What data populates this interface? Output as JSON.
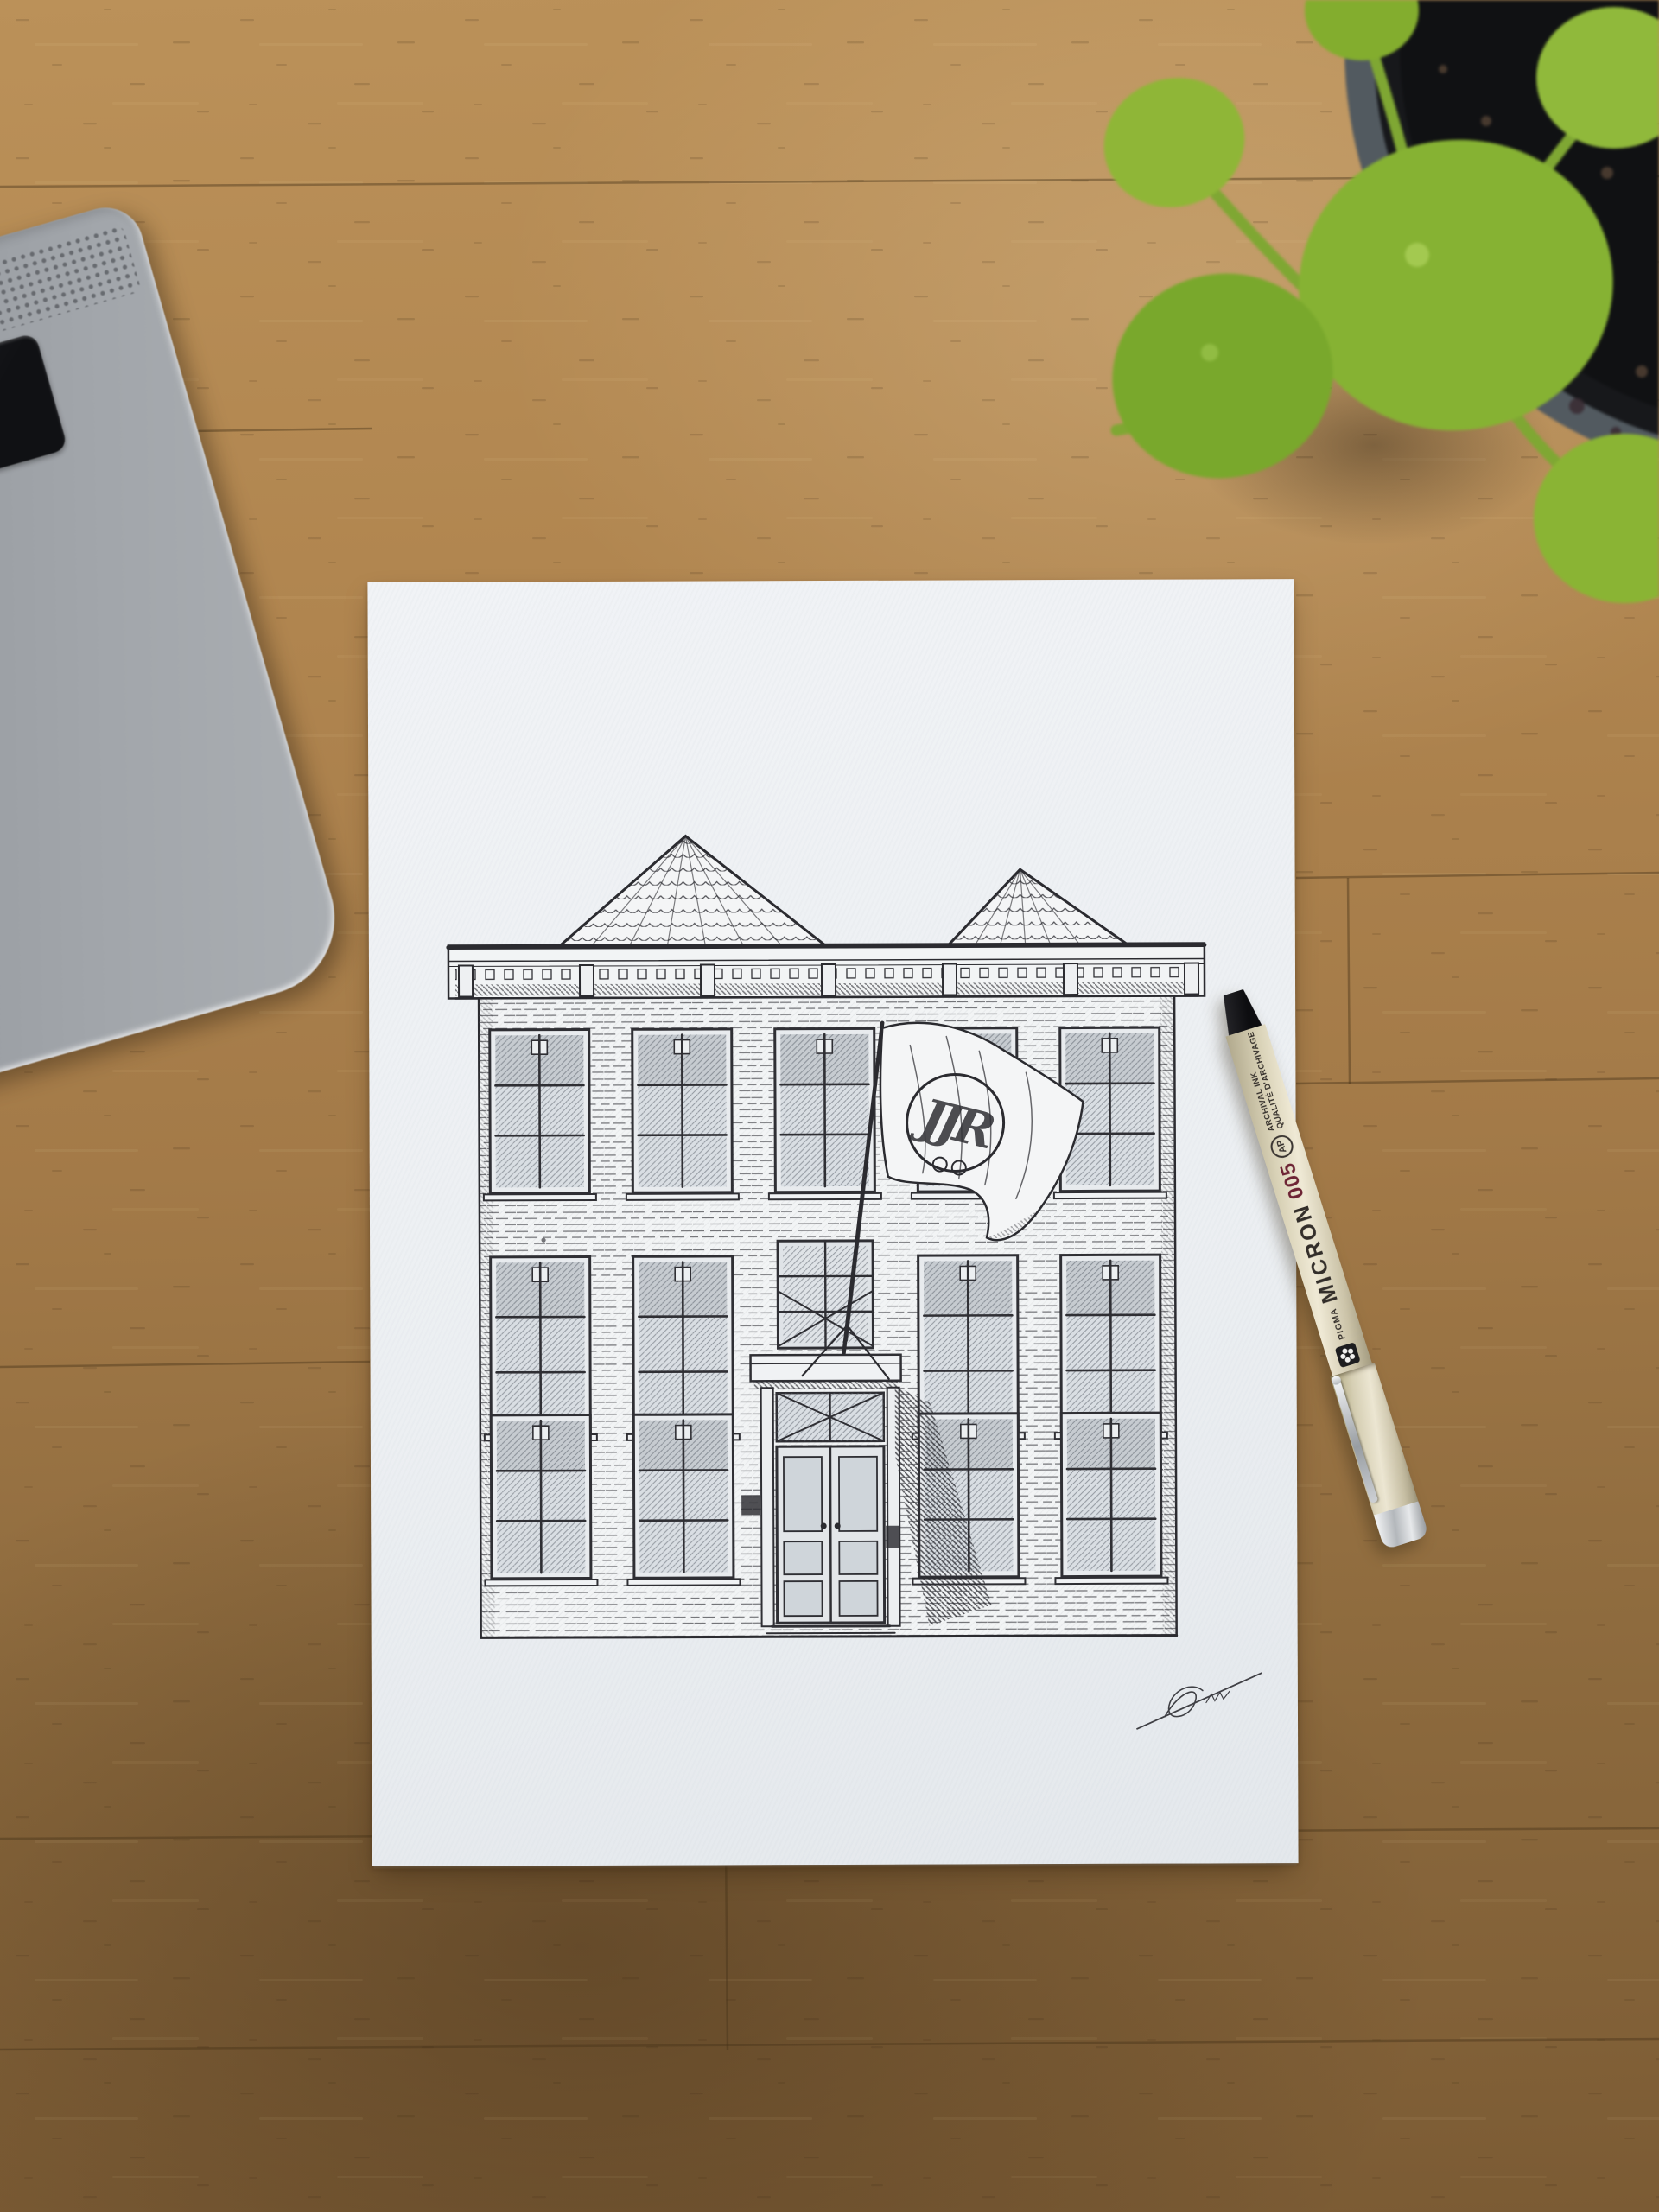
{
  "scene": {
    "subject": "ink drawing of a brick townhouse with two pyramidal roofs and an entrance flag, on textured paper on a wooden desk",
    "objects": [
      "laptop-corner",
      "pilea-plant-in-pot",
      "art-paper",
      "fineliner-pen"
    ]
  },
  "drawing": {
    "flag_monogram": "JJR",
    "ink_color": "#2f2f34",
    "paper_color": "#edf0f3"
  },
  "pen": {
    "brand_prefix": "PIGMA",
    "brand": "MICRON",
    "nib_size": "005",
    "line1": "ARCHIVAL INK",
    "line2": "QUALITÉ D'ARCHIVAGE",
    "cert_mark": "AP",
    "icons": {
      "flower": "sakura-flower-icon",
      "cert": "ap-seal-icon"
    },
    "colors": {
      "barrel": "#d8d2b7",
      "nib_size_text": "#6d2334",
      "plug": "#151517",
      "trim": "#c7cacd"
    }
  },
  "laptop": {
    "key_triangle_glyph": "◀",
    "body_color": "#979ba0"
  },
  "plant": {
    "leaf_color": "#87b434",
    "pot_rim_color": "#525a60",
    "soil_color": "#141518"
  },
  "desk": {
    "wood_light": "#b68d57",
    "wood_dark": "#7b5c35"
  }
}
